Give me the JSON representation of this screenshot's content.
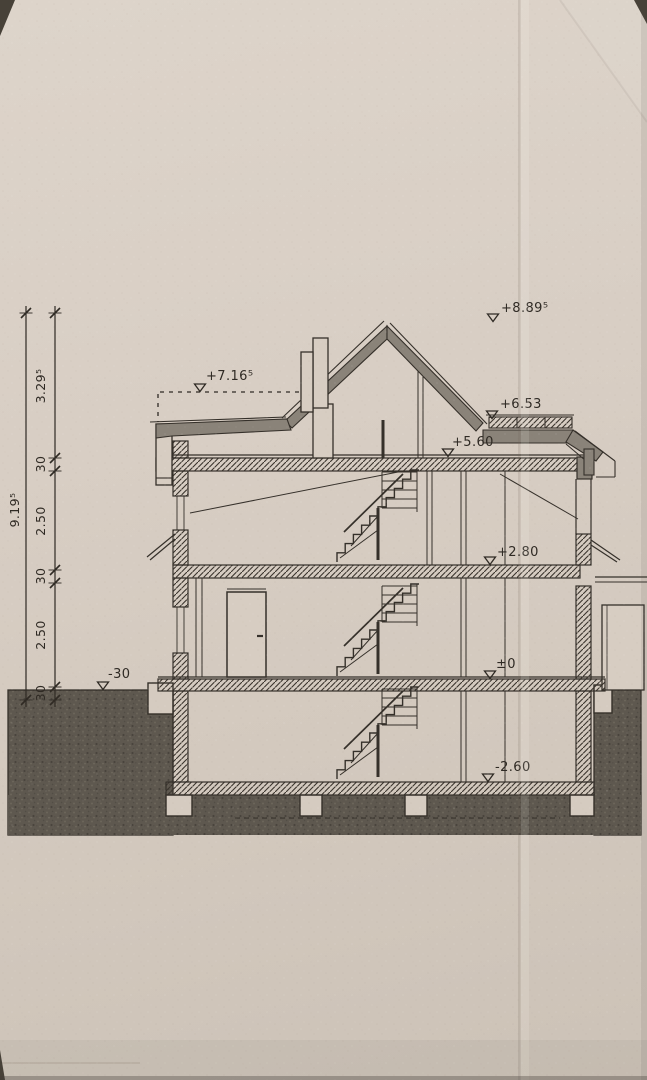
{
  "drawing": {
    "kind_label": "",
    "elevation_markers": {
      "ridge": "+8.89⁵",
      "dormer_flat_roof": "+7.16⁵",
      "balcony_parapet": "+6.53",
      "attic_floor_slab": "+5.60",
      "upper_floor_slab": "+2.80",
      "ground_floor": "±0",
      "basement_floor": "-2.60",
      "grade_level": "-30"
    },
    "dimension_chain": {
      "overall_height": "9.19⁵",
      "segments_top_to_bottom": [
        "3.29⁵",
        "30",
        "2.50",
        "30",
        "2.50",
        "30"
      ]
    },
    "colors": {
      "paper": "#d8cec3",
      "ink": "#35302a",
      "ground_fill": "#5e584f",
      "roof_fill": "#8a8379"
    }
  }
}
